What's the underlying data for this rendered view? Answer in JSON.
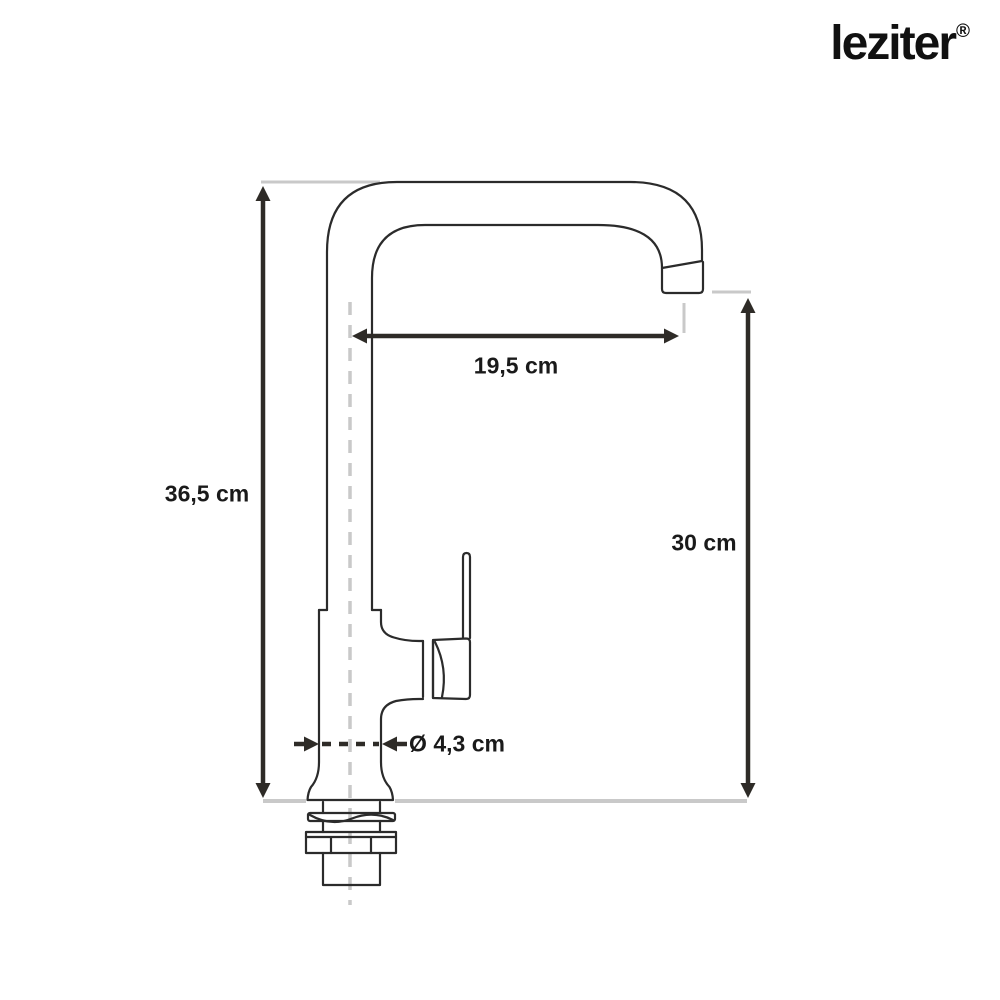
{
  "brand": {
    "name": "leziter",
    "registered": "®"
  },
  "diagram": {
    "subject": "kitchen-faucet-dimension-drawing",
    "dimensions": [
      {
        "id": "total-height",
        "label": "36,5 cm"
      },
      {
        "id": "spout-reach",
        "label": "19,5 cm"
      },
      {
        "id": "spout-height",
        "label": "30 cm"
      },
      {
        "id": "base-diameter",
        "label": "Ø 4,3 cm"
      }
    ],
    "colors": {
      "outline": "#2b2b2b",
      "dimension": "#2e2b27",
      "extension": "#c9c9c9",
      "text": "#1a1a1a",
      "background": "#ffffff"
    }
  }
}
